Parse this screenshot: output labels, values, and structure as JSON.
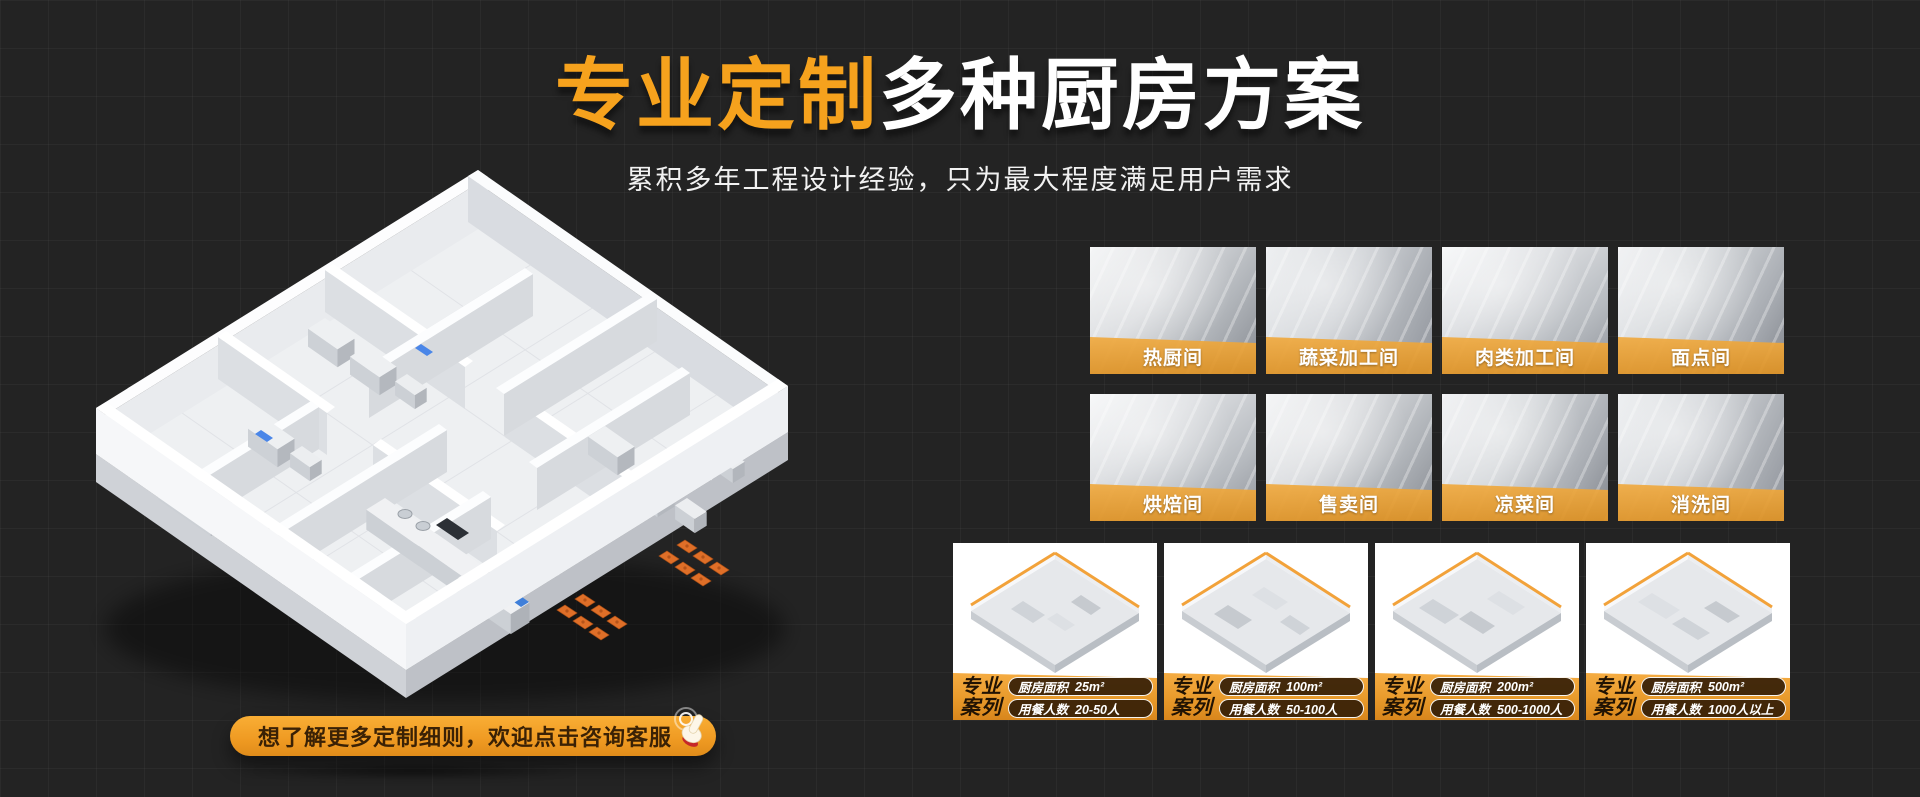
{
  "hero": {
    "title_highlight": "专业定制",
    "title_rest": "多种厨房方案",
    "subtitle": "累积多年工程设计经验，只为最大程度满足用户需求"
  },
  "cta": {
    "label": "想了解更多定制细则，欢迎点击咨询客服",
    "icon": "hand-click-icon"
  },
  "rooms": {
    "items": [
      {
        "label": "热厨间"
      },
      {
        "label": "蔬菜加工间"
      },
      {
        "label": "肉类加工间"
      },
      {
        "label": "面点间"
      },
      {
        "label": "烘焙间"
      },
      {
        "label": "售卖间"
      },
      {
        "label": "凉菜间"
      },
      {
        "label": "消洗间"
      }
    ]
  },
  "cases": {
    "badge": {
      "line1": "专业",
      "line2": "案列"
    },
    "items": [
      {
        "area_label": "厨房面积",
        "area_value": "25m²",
        "diners_label": "用餐人数",
        "diners_value": "20-50人"
      },
      {
        "area_label": "厨房面积",
        "area_value": "100m²",
        "diners_label": "用餐人数",
        "diners_value": "50-100人"
      },
      {
        "area_label": "厨房面积",
        "area_value": "200m²",
        "diners_label": "用餐人数",
        "diners_value": "500-1000人"
      },
      {
        "area_label": "厨房面积",
        "area_value": "500m²",
        "diners_label": "用餐人数",
        "diners_value": "1000人以上"
      }
    ]
  },
  "colors": {
    "background": "#232323",
    "accent_orange": "#F6A21D",
    "label_band": "#E8A03C",
    "pill_background": "#2B1804",
    "pill_text": "#FFFFFF",
    "title_rest_color": "#FFFFFF"
  }
}
